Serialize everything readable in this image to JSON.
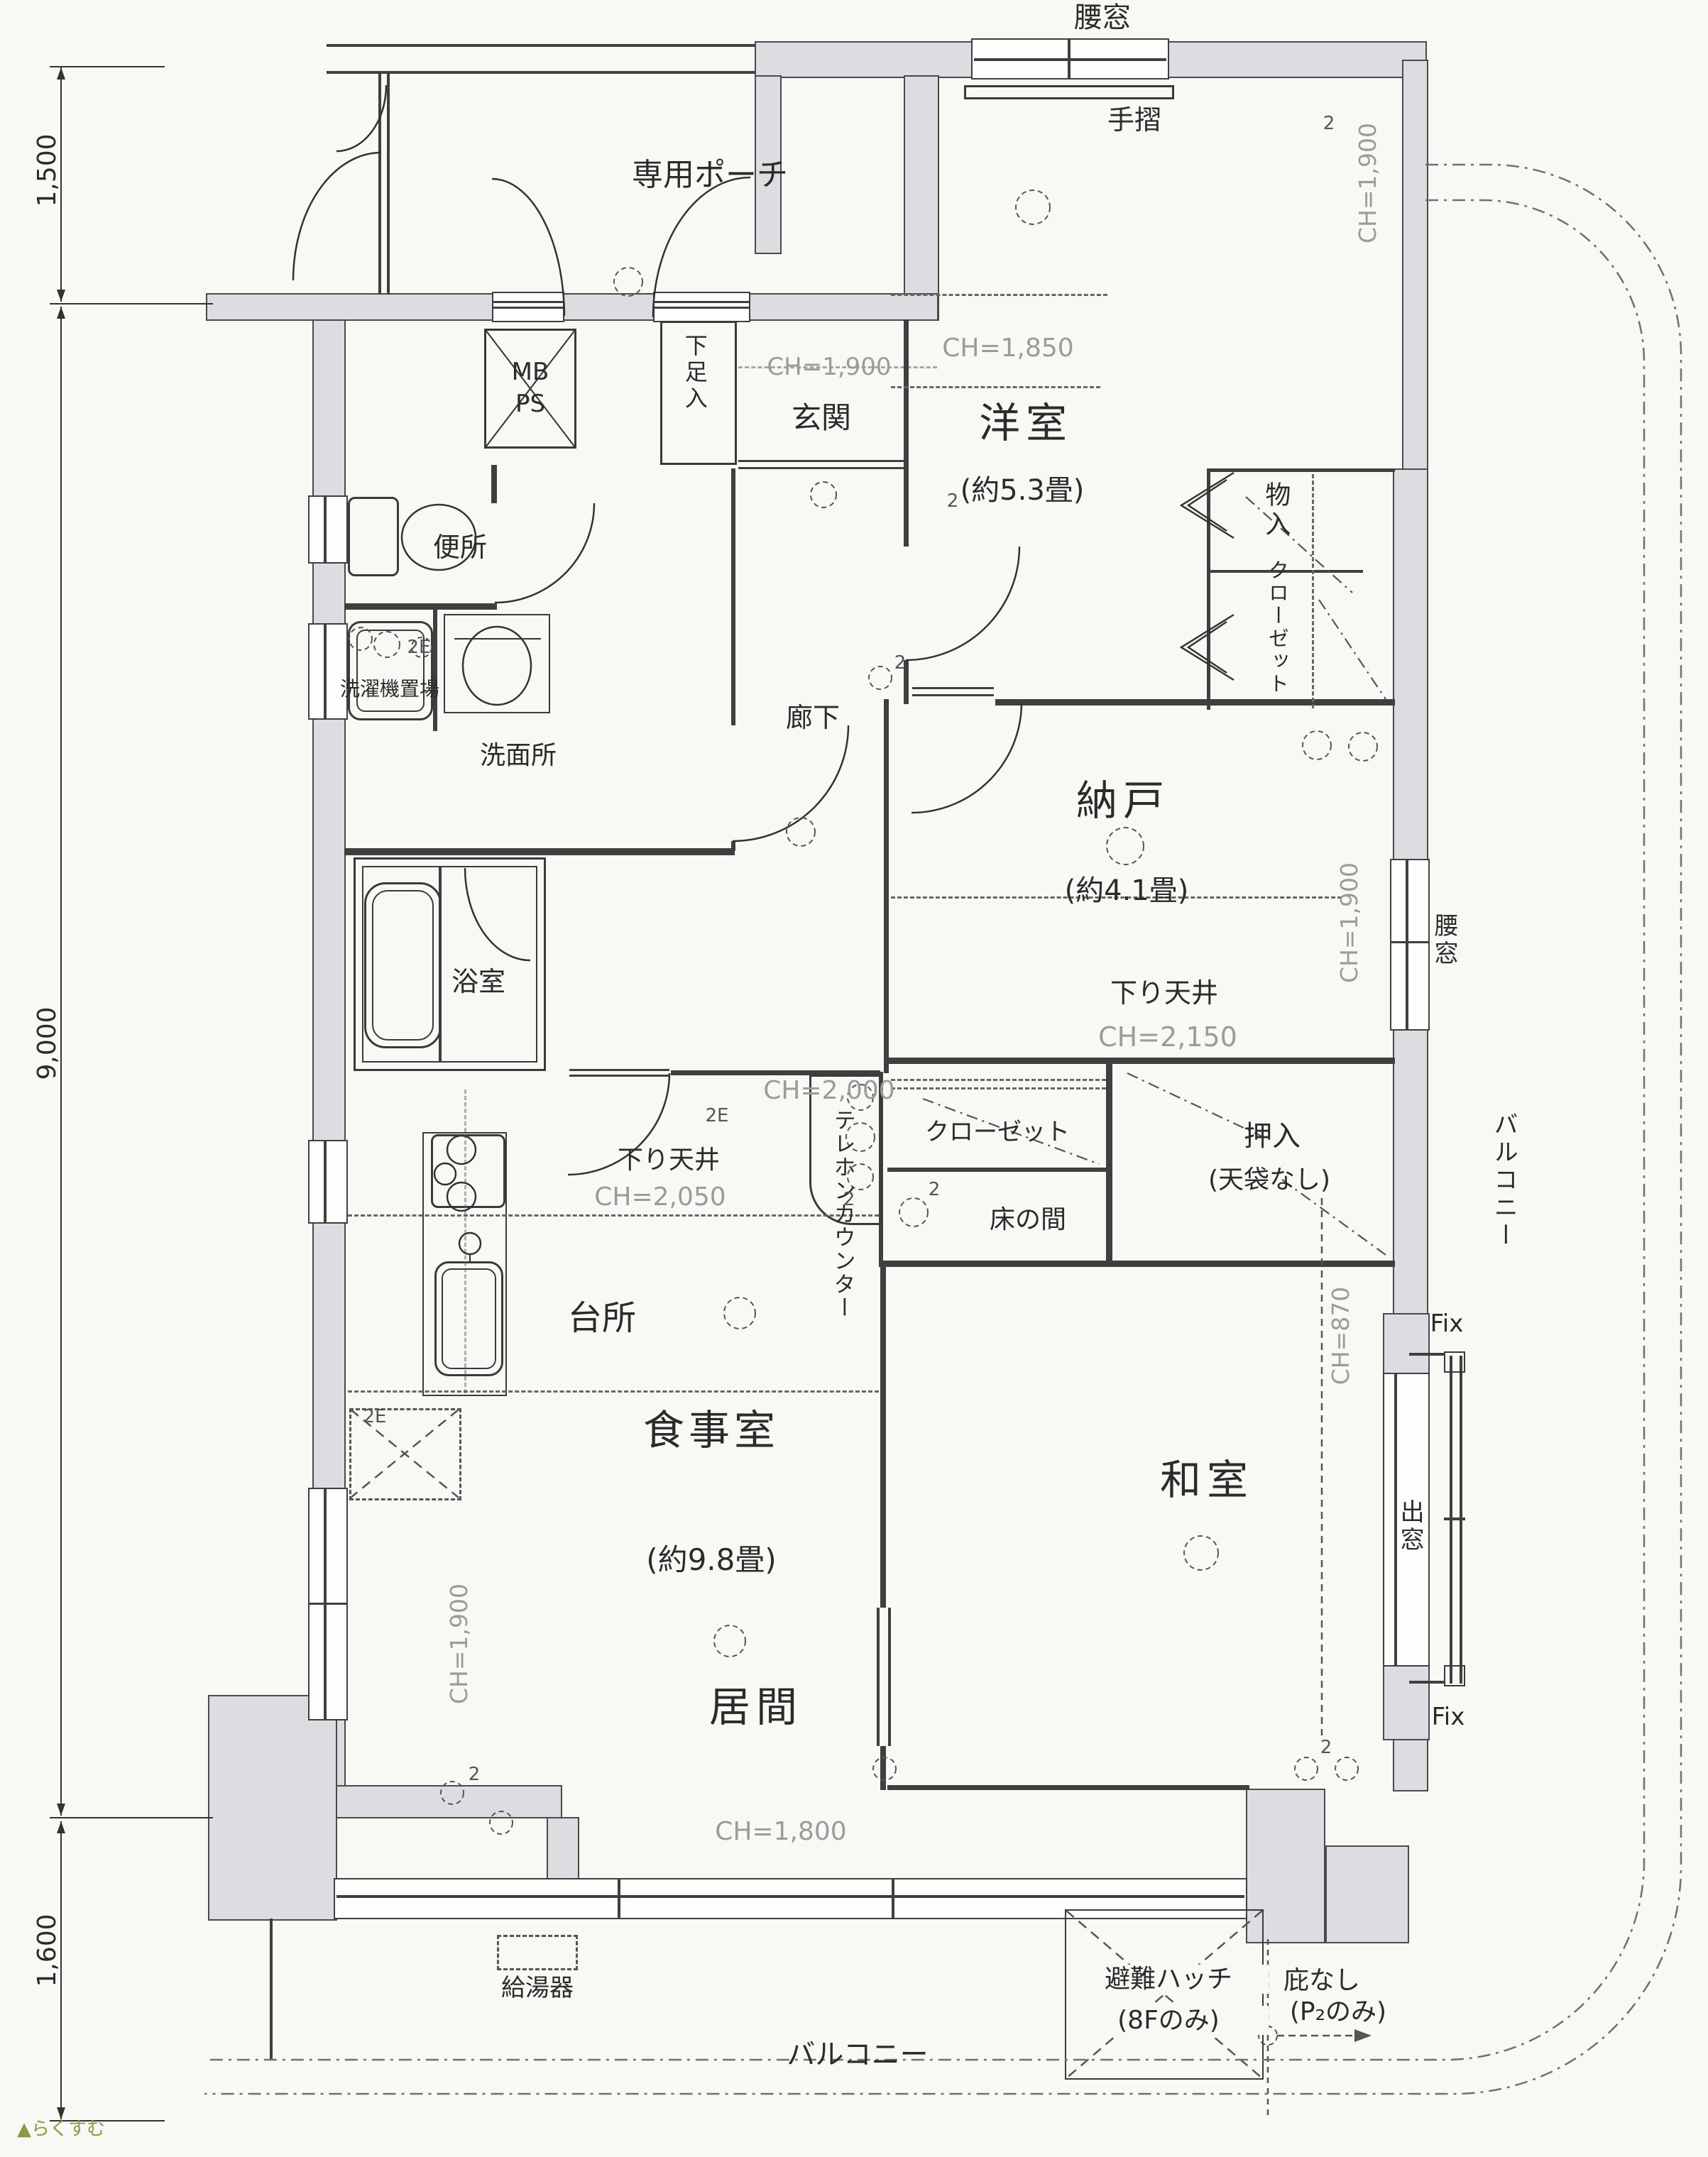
{
  "page": {
    "logo": "らくすむ"
  },
  "dimensions": {
    "top": "1,500",
    "middle": "9,000",
    "bottom": "1,600"
  },
  "rooms": {
    "porch": "専用ポーチ",
    "entrance": "玄関",
    "shoe_closet": "下足入",
    "meter_box": "MB",
    "pipe_space": "PS",
    "toilet": "便所",
    "laundry": "洗濯機置場",
    "washroom": "洗面所",
    "corridor": "廊下",
    "western_room": "洋室",
    "western_room_size": "(約5.3畳)",
    "storeroom": "納戸",
    "storeroom_size": "(約4.1畳)",
    "storage": "物入",
    "closet_west": "クローゼット",
    "bathroom": "浴室",
    "kitchen": "台所",
    "dining_room": "食事室",
    "dining_size": "(約9.8畳)",
    "living_room": "居間",
    "japanese_room": "和室",
    "closet_dk": "クローゼット",
    "tokonoma": "床の間",
    "oshiire": "押入",
    "oshiire_note": "(天袋なし)",
    "telephone_counter": "テレホンカウンター",
    "bay_window": "出窓",
    "balcony_right": "バルコニー",
    "balcony_bottom": "バルコニー",
    "water_heater": "給湯器",
    "escape_hatch": "避難ハッチ",
    "escape_hatch_note": "(8Fのみ)",
    "no_eaves": "庇なし",
    "no_eaves_note": "(P₂のみ)"
  },
  "windows": {
    "waist_top": "腰窓",
    "handrail": "手摺",
    "waist_right": "腰窓",
    "fix_top": "Fix",
    "fix_bottom": "Fix"
  },
  "ceiling": {
    "entrance": "CH=1,900",
    "western_wall": "CH=1,900",
    "western": "CH=1,850",
    "storeroom_drop": "下り天井",
    "storeroom_drop_h": "CH=2,150",
    "storeroom_wall": "CH=1,900",
    "dk": "CH=2,000",
    "dk_drop": "下り天井",
    "dk_drop_h": "CH=2,050",
    "living_wall": "CH=1,900",
    "bay": "CH=870",
    "south_window": "CH=1,800"
  },
  "marks": {
    "m2e": "2E",
    "m2": "2"
  }
}
